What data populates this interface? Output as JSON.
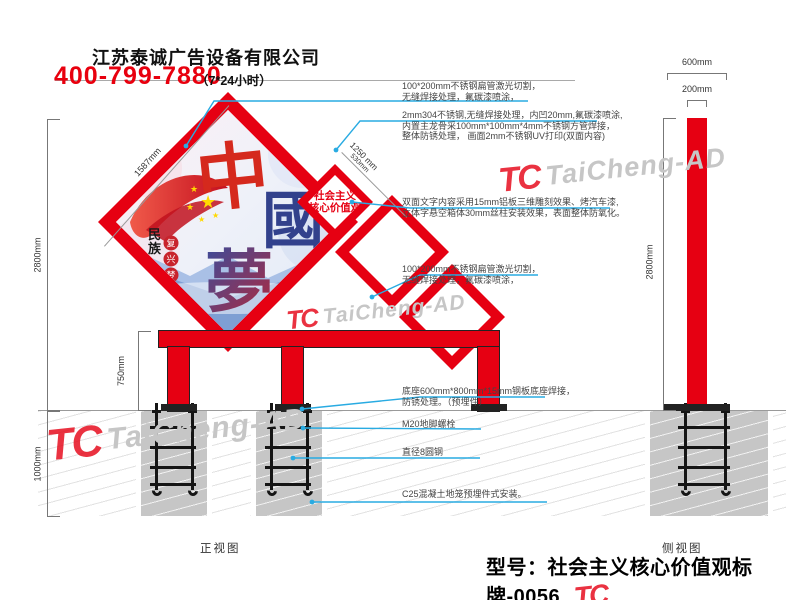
{
  "header": {
    "company": "江苏泰诚广告设备有限公司",
    "phone": "400-799-7880",
    "hours": "（7*24小时）"
  },
  "watermark": {
    "logo": "TC",
    "text": "TaiCheng-AD"
  },
  "annotations": [
    {
      "lines": [
        "100*200mm不锈钢扁管激光切割，",
        "无缝焊接处理，氟碳漆喷涂，"
      ]
    },
    {
      "lines": [
        "2mm304不锈钢,无缝焊接处理，内凹20mm,氟碳漆喷涂,",
        "内置主龙骨采100mm*100mm*4mm不锈钢方管焊接，",
        "整体防锈处理， 画面2mm不锈钢UV打印(双面内容)"
      ]
    },
    {
      "lines": [
        "双面文字内容采用15mm铝板三维雕刻效果、烤汽车漆,",
        "立体字悬空箱体30mm丝柱安装效果，表面整体防氧化。"
      ]
    },
    {
      "lines": [
        "100*200mm不锈钢扁管激光切割，",
        "无缝焊接处理，氟碳漆喷涂，"
      ]
    },
    {
      "lines": [
        "底座600mm*800mm*15mm钢板底座焊接，",
        "防锈处理。（预埋件）"
      ]
    },
    {
      "lines": [
        "M20地脚螺栓"
      ]
    },
    {
      "lines": [
        "直径8圆钢"
      ]
    },
    {
      "lines": [
        "C25混凝土地笼预埋件式安装。"
      ]
    }
  ],
  "dimensions": {
    "front_total": "2800mm",
    "underground": "1000mm",
    "leg_height": "750mm",
    "panel_edge": "1587mm",
    "small_panel_edge": "1250 mm",
    "small_panel_edge_sub": "530mm",
    "side_base": "600mm",
    "side_pole": "200mm",
    "side_total": "2800mm"
  },
  "views": {
    "front": "正视图",
    "side": "侧视图"
  },
  "small_sign": {
    "line1": "社会主义",
    "line2": "核心价值观"
  },
  "artwork": {
    "title": "中國夢",
    "nation": "民族",
    "seals": "复兴梦"
  },
  "footer": {
    "model": "型号：社会主义核心价值观标牌-0056"
  },
  "colors": {
    "red": "#e60012",
    "leader_blue": "#29abe2",
    "pier_gray": "#c6c6c6",
    "watermark_gray": "#c6c6c6"
  }
}
